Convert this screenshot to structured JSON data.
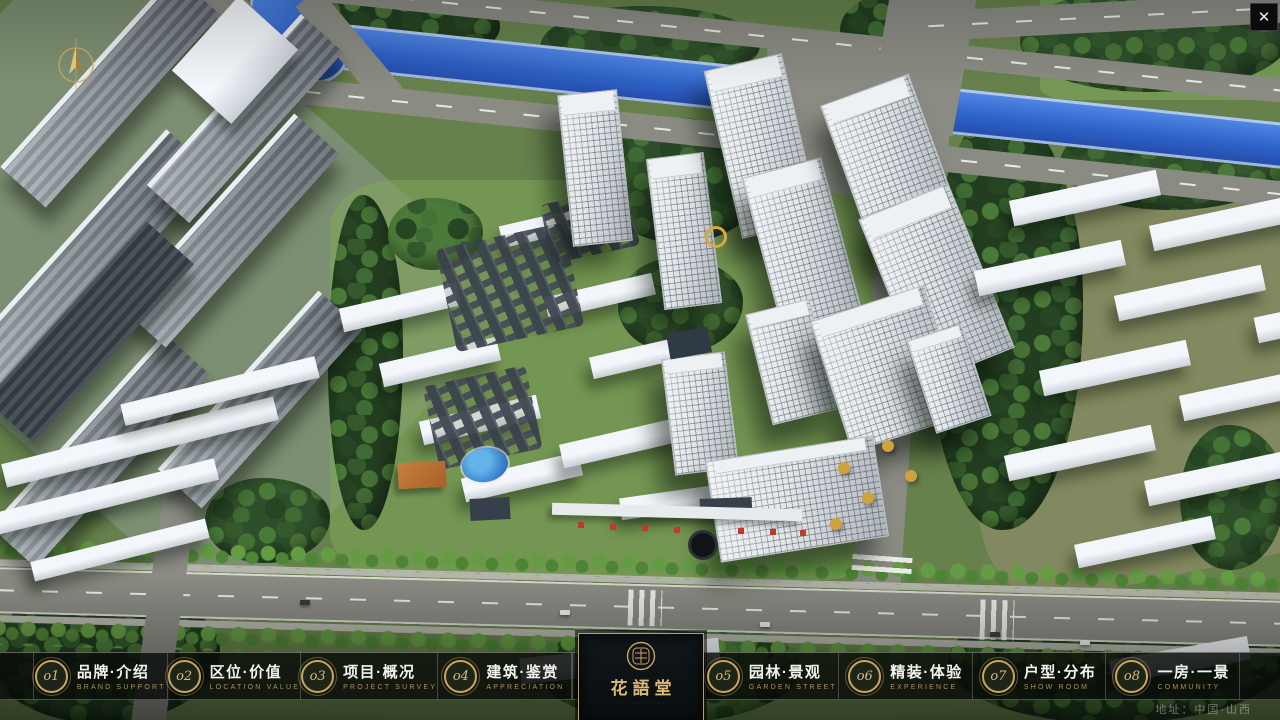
{
  "window": {
    "close_icon": "✕"
  },
  "menu": {
    "items": [
      {
        "num": "o1",
        "title": "品牌·介绍",
        "subtitle": "BRAND SUPPORT"
      },
      {
        "num": "o2",
        "title": "区位·价值",
        "subtitle": "LOCATION VALUE"
      },
      {
        "num": "o3",
        "title": "项目·概况",
        "subtitle": "PROJECT SURVEY"
      },
      {
        "num": "o4",
        "title": "建筑·鉴赏",
        "subtitle": "APPRECIATION"
      },
      {
        "num": "o5",
        "title": "园林·景观",
        "subtitle": "GARDEN STREET"
      },
      {
        "num": "o6",
        "title": "精装·体验",
        "subtitle": "EXPERIENCE"
      },
      {
        "num": "o7",
        "title": "户型·分布",
        "subtitle": "SHOW ROOM"
      },
      {
        "num": "o8",
        "title": "一房·一景",
        "subtitle": "COMMUNITY"
      }
    ]
  },
  "logo": {
    "title": "花語堂",
    "tagline": "· · · · · · · · · ·"
  },
  "footer": {
    "address": "地址：中国·山西"
  },
  "colors": {
    "accent_gold": "#c9a55f",
    "river_blue": "#2f63c8"
  }
}
